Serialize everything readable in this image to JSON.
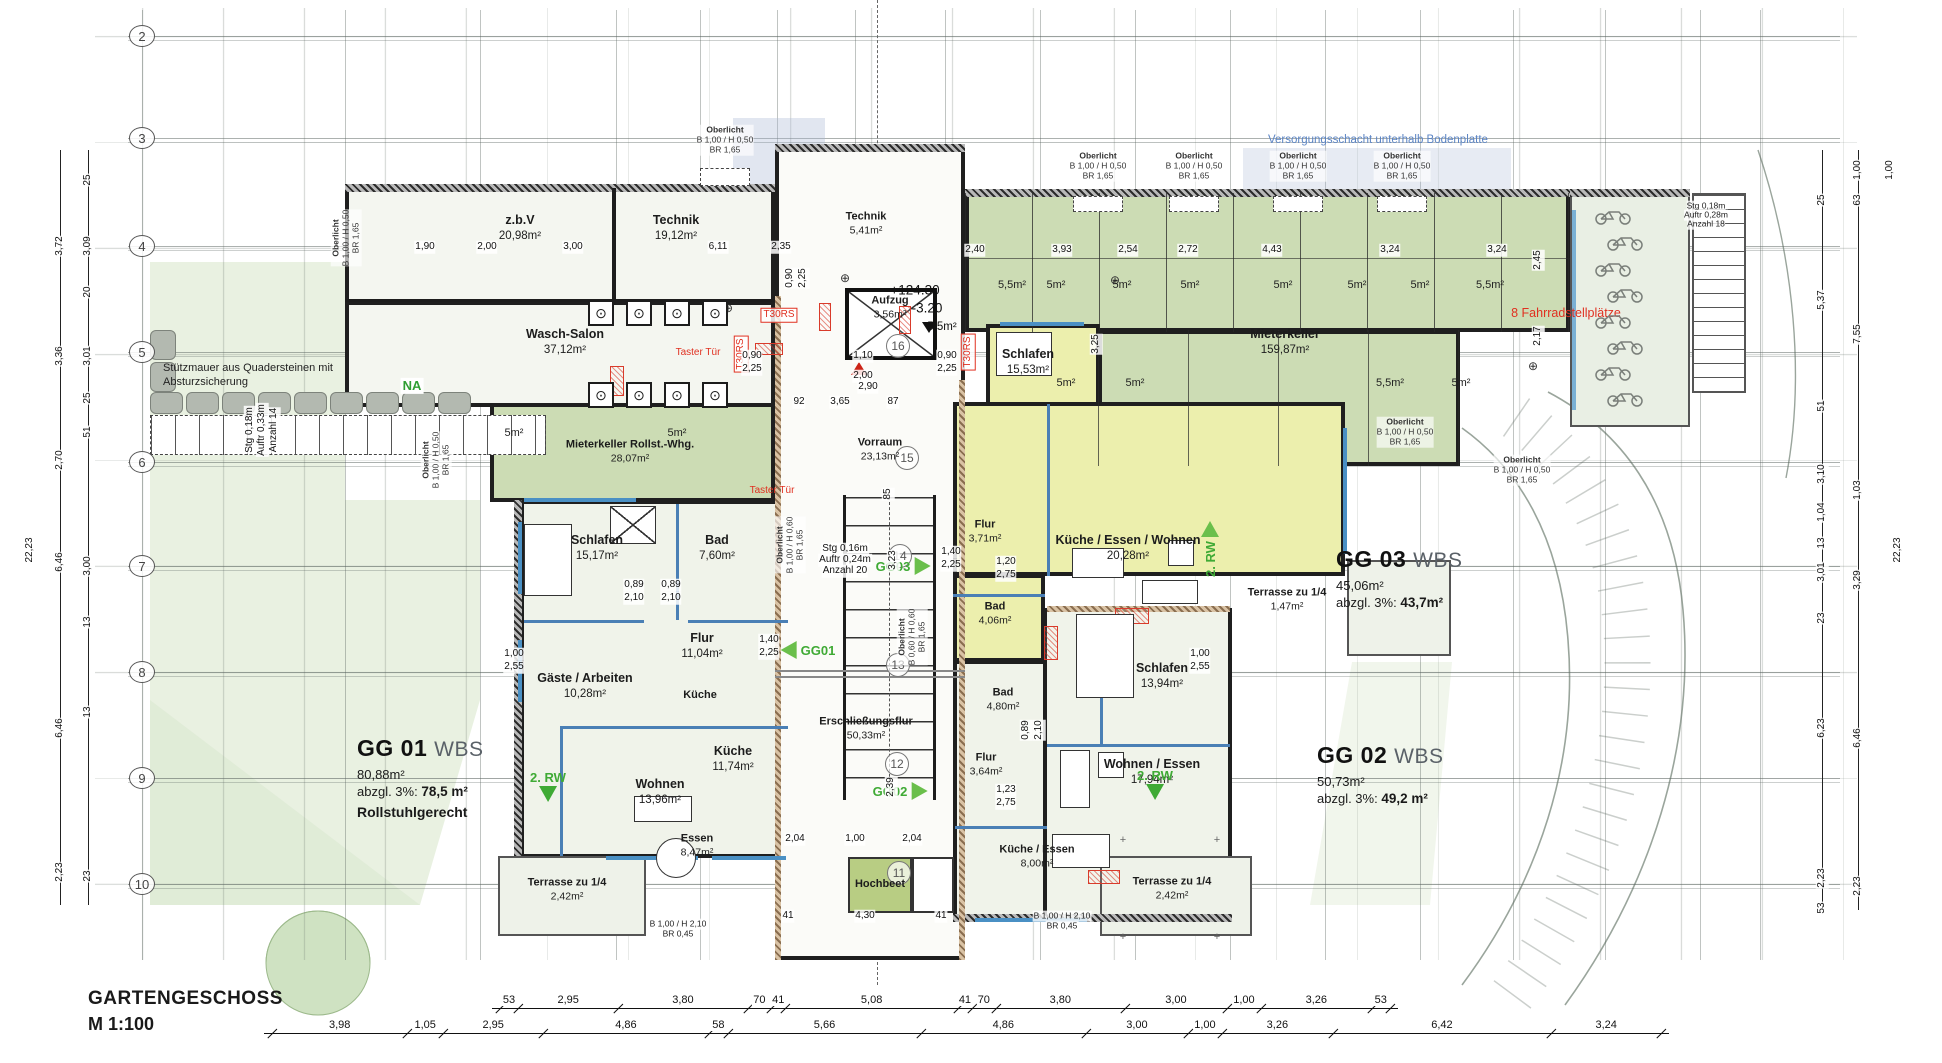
{
  "title": {
    "line1": "GARTENGESCHOSS",
    "line2": "M 1:100"
  },
  "colors": {
    "keller_green": "#ccdcb4",
    "apartment_yellow": "#ecefad",
    "floor": "#f0f3ea",
    "wall": "#1d1d1d",
    "window_blue": "#4a90c4",
    "accent_red": "#e03020",
    "arrow_green": "#3faa35",
    "annotation_blue": "#5b84c4"
  },
  "grid_bubbles": [
    {
      "n": "2",
      "y": 36
    },
    {
      "n": "3",
      "y": 138
    },
    {
      "n": "4",
      "y": 246
    },
    {
      "n": "5",
      "y": 352
    },
    {
      "n": "6",
      "y": 462
    },
    {
      "n": "7",
      "y": 566
    },
    {
      "n": "8",
      "y": 672
    },
    {
      "n": "9",
      "y": 778
    },
    {
      "n": "10",
      "y": 884
    }
  ],
  "axis_circles": [
    {
      "n": "16",
      "x": 898,
      "y": 346
    },
    {
      "n": "15",
      "x": 907,
      "y": 458
    },
    {
      "n": "14",
      "x": 900,
      "y": 556
    },
    {
      "n": "13",
      "x": 898,
      "y": 665
    },
    {
      "n": "12",
      "x": 897,
      "y": 764
    },
    {
      "n": "11",
      "x": 899,
      "y": 873
    }
  ],
  "apartments": [
    {
      "code": "GG 01",
      "std": "WBS",
      "gross": "80,88m²",
      "net_prefix": "abzgl. 3%: ",
      "net": "78,5 m²",
      "note": "Rollstuhlgerecht",
      "x": 357,
      "y": 735
    },
    {
      "code": "GG 02",
      "std": "WBS",
      "gross": "50,73m²",
      "net_prefix": "abzgl. 3%: ",
      "net": "49,2 m²",
      "note": "",
      "x": 1317,
      "y": 742
    },
    {
      "code": "GG 03",
      "std": "WBS",
      "gross": "45,06m²",
      "net_prefix": "abzgl. 3%: ",
      "net": "43,7m²",
      "note": "",
      "x": 1336,
      "y": 546
    }
  ],
  "rooms": [
    {
      "name": "z.b.V",
      "area": "20,98m²",
      "x": 520,
      "y": 228,
      "c": ""
    },
    {
      "name": "Technik",
      "area": "19,12m²",
      "x": 676,
      "y": 228,
      "c": ""
    },
    {
      "name": "Technik",
      "area": "5,41m²",
      "x": 866,
      "y": 224,
      "c": "sm"
    },
    {
      "name": "Wasch-Salon",
      "area": "37,12m²",
      "x": 565,
      "y": 342,
      "c": ""
    },
    {
      "name": "Mieterkeller Rollst.-Whg.",
      "area": "28,07m²",
      "x": 630,
      "y": 452,
      "c": "sm"
    },
    {
      "name": "Vorraum",
      "area": "23,13m²",
      "x": 880,
      "y": 450,
      "c": "sm"
    },
    {
      "name": "Mieterkeller",
      "area": "159,87m²",
      "x": 1285,
      "y": 342,
      "c": ""
    },
    {
      "name": "Aufzug",
      "area": "3,56m²",
      "x": 890,
      "y": 308,
      "c": "sm"
    },
    {
      "name": "Schlafen",
      "area": "15,17m²",
      "x": 597,
      "y": 548,
      "c": ""
    },
    {
      "name": "Bad",
      "area": "7,60m²",
      "x": 717,
      "y": 548,
      "c": ""
    },
    {
      "name": "Flur",
      "area": "11,04m²",
      "x": 702,
      "y": 646,
      "c": ""
    },
    {
      "name": "Gäste / Arbeiten",
      "area": "10,28m²",
      "x": 585,
      "y": 686,
      "c": ""
    },
    {
      "name": "Küche",
      "area": "",
      "x": 700,
      "y": 696,
      "c": "sm"
    },
    {
      "name": "Küche",
      "area": "11,74m²",
      "x": 733,
      "y": 759,
      "c": ""
    },
    {
      "name": "Wohnen",
      "area": "13,96m²",
      "x": 660,
      "y": 792,
      "c": ""
    },
    {
      "name": "Essen",
      "area": "8,47m²",
      "x": 697,
      "y": 846,
      "c": "sm"
    },
    {
      "name": "Terrasse zu 1/4",
      "area": "2,42m²",
      "x": 567,
      "y": 890,
      "c": "sm"
    },
    {
      "name": "Erschließungsflur",
      "area": "50,33m²",
      "x": 866,
      "y": 729,
      "c": "sm"
    },
    {
      "name": "Flur",
      "area": "3,71m²",
      "x": 985,
      "y": 532,
      "c": "sm"
    },
    {
      "name": "Schlafen",
      "area": "15,53m²",
      "x": 1028,
      "y": 362,
      "c": ""
    },
    {
      "name": "Küche / Essen / Wohnen",
      "area": "20,28m²",
      "x": 1128,
      "y": 548,
      "c": ""
    },
    {
      "name": "Bad",
      "area": "4,06m²",
      "x": 995,
      "y": 614,
      "c": "sm"
    },
    {
      "name": "Terrasse zu 1/4",
      "area": "1,47m²",
      "x": 1287,
      "y": 600,
      "c": "sm"
    },
    {
      "name": "Schlafen",
      "area": "13,94m²",
      "x": 1162,
      "y": 676,
      "c": ""
    },
    {
      "name": "Bad",
      "area": "4,80m²",
      "x": 1003,
      "y": 700,
      "c": "sm"
    },
    {
      "name": "Flur",
      "area": "3,64m²",
      "x": 986,
      "y": 765,
      "c": "sm"
    },
    {
      "name": "Wohnen / Essen",
      "area": "17,94m²",
      "x": 1152,
      "y": 772,
      "c": ""
    },
    {
      "name": "Küche / Essen",
      "area": "8,00m²",
      "x": 1037,
      "y": 857,
      "c": "sm"
    },
    {
      "name": "Terrasse zu 1/4",
      "area": "2,42m²",
      "x": 1172,
      "y": 889,
      "c": "sm"
    },
    {
      "name": "Hochbeet",
      "area": "",
      "x": 880,
      "y": 885,
      "c": "sm"
    }
  ],
  "annotations": [
    {
      "t": "Stützmauer aus Quadersteinen mit",
      "x": 163,
      "y": 368,
      "c": "note"
    },
    {
      "t": "Absturzsicherung",
      "x": 163,
      "y": 382,
      "c": "note"
    },
    {
      "t": "NA",
      "x": 412,
      "y": 386,
      "c": "green"
    },
    {
      "t": "Versorgungsschacht unterhalb Bodenplatte",
      "x": 1268,
      "y": 140,
      "c": "blue"
    },
    {
      "t": "8 Fahrradstellplätze",
      "x": 1566,
      "y": 314,
      "c": "red"
    },
    {
      "t": "+124.30",
      "x": 915,
      "y": 291,
      "c": "level"
    },
    {
      "t": "-3.20",
      "x": 927,
      "y": 309,
      "c": "level"
    },
    {
      "t": "5,5m²",
      "x": 942,
      "y": 327,
      "c": "levelsm"
    },
    {
      "t": "T30RS",
      "x": 779,
      "y": 315,
      "c": "redbox"
    },
    {
      "t": "T30RS",
      "x": 741,
      "y": 354,
      "c": "redbox",
      "r": 1
    },
    {
      "t": "T30RS",
      "x": 968,
      "y": 352,
      "c": "redbox",
      "r": 1
    },
    {
      "t": "Taster Tür",
      "x": 698,
      "y": 353,
      "c": "redsm"
    },
    {
      "t": "Taster Tür",
      "x": 772,
      "y": 491,
      "c": "redsm"
    },
    {
      "t": "Stg 0,16m",
      "x": 845,
      "y": 549,
      "c": "dim"
    },
    {
      "t": "Auftr 0,24m",
      "x": 845,
      "y": 560,
      "c": "dim"
    },
    {
      "t": "Anzahl 20",
      "x": 845,
      "y": 571,
      "c": "dim"
    },
    {
      "t": "Stg 0,18m",
      "x": 250,
      "y": 430,
      "c": "dim",
      "r": 1
    },
    {
      "t": "Auftr 0,33m",
      "x": 262,
      "y": 430,
      "c": "dim",
      "r": 1
    },
    {
      "t": "Anzahl 14",
      "x": 274,
      "y": 430,
      "c": "dim",
      "r": 1
    },
    {
      "t": "Stg 0,18m",
      "x": 1706,
      "y": 206,
      "c": "xs"
    },
    {
      "t": "Auftr 0,28m",
      "x": 1706,
      "y": 215,
      "c": "xs"
    },
    {
      "t": "Anzahl 18",
      "x": 1706,
      "y": 224,
      "c": "xs"
    }
  ],
  "arrows": [
    {
      "t": "GG01",
      "d": "left",
      "x": 808,
      "y": 650
    },
    {
      "t": "GG03",
      "d": "right",
      "x": 903,
      "y": 566
    },
    {
      "t": "GG02",
      "d": "right",
      "x": 900,
      "y": 791
    },
    {
      "t": "2. RW",
      "d": "down",
      "x": 548,
      "y": 786
    },
    {
      "t": "2. RW",
      "d": "right",
      "x": 1210,
      "y": 549,
      "r": 1
    },
    {
      "t": "2. RW",
      "d": "down",
      "x": 1155,
      "y": 784
    }
  ],
  "oberlicht": [
    {
      "lines": [
        "Oberlicht",
        "B 1,00 / H 0,50",
        "BR 1,65"
      ],
      "x": 725,
      "y": 140
    },
    {
      "lines": [
        "Oberlicht",
        "B 1,00 / H 0,50",
        "BR 1,65"
      ],
      "x": 1098,
      "y": 166
    },
    {
      "lines": [
        "Oberlicht",
        "B 1,00 / H 0,50",
        "BR 1,65"
      ],
      "x": 1194,
      "y": 166
    },
    {
      "lines": [
        "Oberlicht",
        "B 1,00 / H 0,50",
        "BR 1,65"
      ],
      "x": 1298,
      "y": 166
    },
    {
      "lines": [
        "Oberlicht",
        "B 1,00 / H 0,50",
        "BR 1,65"
      ],
      "x": 1402,
      "y": 166
    },
    {
      "lines": [
        "Oberlicht",
        "B 1,00 / H 0,50",
        "BR 1,65"
      ],
      "x": 1405,
      "y": 432
    },
    {
      "lines": [
        "Oberlicht",
        "B 1,00 / H 0,50",
        "BR 1,65"
      ],
      "x": 1522,
      "y": 470
    },
    {
      "lines": [
        "Oberlicht",
        "B 1,00 / H 0,50",
        "BR 1,65"
      ],
      "x": 346,
      "y": 238,
      "r": 1
    },
    {
      "lines": [
        "Oberlicht",
        "B 1,00 / H 0,50",
        "BR 1,65"
      ],
      "x": 436,
      "y": 460,
      "r": 1
    },
    {
      "lines": [
        "Oberlicht",
        "B 1,00 / H 0,60",
        "BR 1,65"
      ],
      "x": 790,
      "y": 545,
      "r": 1
    },
    {
      "lines": [
        "Oberlicht",
        "B 0,60 / H 0,60",
        "BR 1,65"
      ],
      "x": 912,
      "y": 637,
      "r": 1
    }
  ],
  "dims": [
    {
      "t": "1,90",
      "x": 425,
      "y": 247
    },
    {
      "t": "2,00",
      "x": 487,
      "y": 247
    },
    {
      "t": "3,00",
      "x": 573,
      "y": 247
    },
    {
      "t": "6,11",
      "x": 718,
      "y": 247
    },
    {
      "t": "2,35",
      "x": 781,
      "y": 247
    },
    {
      "t": "0,90",
      "x": 790,
      "y": 278,
      "r": 1
    },
    {
      "t": "2,25",
      "x": 803,
      "y": 278,
      "r": 1
    },
    {
      "t": "0,90",
      "x": 752,
      "y": 356
    },
    {
      "t": "2,25",
      "x": 752,
      "y": 369
    },
    {
      "t": "0,90",
      "x": 947,
      "y": 356
    },
    {
      "t": "2,25",
      "x": 947,
      "y": 369
    },
    {
      "t": "1,10",
      "x": 863,
      "y": 356
    },
    {
      "t": "2,00",
      "x": 863,
      "y": 376
    },
    {
      "t": "92",
      "x": 799,
      "y": 402
    },
    {
      "t": "3,65",
      "x": 840,
      "y": 402
    },
    {
      "t": "87",
      "x": 893,
      "y": 402
    },
    {
      "t": "2,90",
      "x": 868,
      "y": 387
    },
    {
      "t": "3,25",
      "x": 1096,
      "y": 344,
      "r": 1
    },
    {
      "t": "2,40",
      "x": 975,
      "y": 250
    },
    {
      "t": "3,93",
      "x": 1062,
      "y": 250
    },
    {
      "t": "2,54",
      "x": 1128,
      "y": 250
    },
    {
      "t": "2,72",
      "x": 1188,
      "y": 250
    },
    {
      "t": "4,43",
      "x": 1272,
      "y": 250
    },
    {
      "t": "3,24",
      "x": 1390,
      "y": 250
    },
    {
      "t": "3,24",
      "x": 1497,
      "y": 250
    },
    {
      "t": "2,45",
      "x": 1538,
      "y": 260,
      "r": 1
    },
    {
      "t": "2,17",
      "x": 1538,
      "y": 336,
      "r": 1
    },
    {
      "t": "5,5m²",
      "x": 1012,
      "y": 286,
      "c": "cell"
    },
    {
      "t": "5m²",
      "x": 1056,
      "y": 286,
      "c": "cell"
    },
    {
      "t": "5m²",
      "x": 1122,
      "y": 286,
      "c": "cell"
    },
    {
      "t": "5m²",
      "x": 1190,
      "y": 286,
      "c": "cell"
    },
    {
      "t": "5m²",
      "x": 1283,
      "y": 286,
      "c": "cell"
    },
    {
      "t": "5m²",
      "x": 1357,
      "y": 286,
      "c": "cell"
    },
    {
      "t": "5m²",
      "x": 1420,
      "y": 286,
      "c": "cell"
    },
    {
      "t": "5,5m²",
      "x": 1490,
      "y": 286,
      "c": "cell"
    },
    {
      "t": "5m²",
      "x": 1066,
      "y": 384,
      "c": "cell"
    },
    {
      "t": "5m²",
      "x": 1135,
      "y": 384,
      "c": "cell"
    },
    {
      "t": "5,5m²",
      "x": 1390,
      "y": 384,
      "c": "cell"
    },
    {
      "t": "5m²",
      "x": 1461,
      "y": 384,
      "c": "cell"
    },
    {
      "t": "5m²",
      "x": 514,
      "y": 434,
      "c": "cell"
    },
    {
      "t": "5m²",
      "x": 677,
      "y": 434,
      "c": "cell"
    },
    {
      "t": "0,89",
      "x": 634,
      "y": 585
    },
    {
      "t": "2,10",
      "x": 634,
      "y": 598
    },
    {
      "t": "0,89",
      "x": 671,
      "y": 585
    },
    {
      "t": "2,10",
      "x": 671,
      "y": 598
    },
    {
      "t": "1,40",
      "x": 769,
      "y": 640
    },
    {
      "t": "2,25",
      "x": 769,
      "y": 653
    },
    {
      "t": "1,00",
      "x": 514,
      "y": 654
    },
    {
      "t": "2,55",
      "x": 514,
      "y": 667
    },
    {
      "t": "1,40",
      "x": 951,
      "y": 552
    },
    {
      "t": "2,25",
      "x": 951,
      "y": 565
    },
    {
      "t": "1,20",
      "x": 1006,
      "y": 562
    },
    {
      "t": "2,75",
      "x": 1006,
      "y": 575
    },
    {
      "t": "1,00",
      "x": 1200,
      "y": 654
    },
    {
      "t": "2,55",
      "x": 1200,
      "y": 667
    },
    {
      "t": "0,89",
      "x": 1026,
      "y": 730,
      "r": 1
    },
    {
      "t": "2,10",
      "x": 1039,
      "y": 730,
      "r": 1
    },
    {
      "t": "1,23",
      "x": 1006,
      "y": 790
    },
    {
      "t": "2,75",
      "x": 1006,
      "y": 803
    },
    {
      "t": "85",
      "x": 888,
      "y": 494,
      "r": 1
    },
    {
      "t": "3,23",
      "x": 893,
      "y": 560,
      "r": 1
    },
    {
      "t": "2,39",
      "x": 891,
      "y": 787,
      "r": 1
    },
    {
      "t": "2,04",
      "x": 795,
      "y": 839
    },
    {
      "t": "1,00",
      "x": 855,
      "y": 839
    },
    {
      "t": "2,04",
      "x": 912,
      "y": 839
    },
    {
      "t": "41",
      "x": 788,
      "y": 916
    },
    {
      "t": "4,30",
      "x": 865,
      "y": 916
    },
    {
      "t": "41",
      "x": 941,
      "y": 916
    },
    {
      "t": "B 1,00 / H 2,10",
      "x": 678,
      "y": 924,
      "c": "xs"
    },
    {
      "t": "BR 0,45",
      "x": 678,
      "y": 934,
      "c": "xs"
    },
    {
      "t": "B 1,00 / H 2,10",
      "x": 1062,
      "y": 916,
      "c": "xs"
    },
    {
      "t": "BR 0,45",
      "x": 1062,
      "y": 926,
      "c": "xs"
    },
    {
      "t": "25",
      "x": 88,
      "y": 180,
      "r": 1
    },
    {
      "t": "3,72",
      "x": 60,
      "y": 246,
      "r": 1
    },
    {
      "t": "3,09",
      "x": 88,
      "y": 246,
      "r": 1
    },
    {
      "t": "20",
      "x": 88,
      "y": 292,
      "r": 1
    },
    {
      "t": "3,36",
      "x": 60,
      "y": 356,
      "r": 1
    },
    {
      "t": "3,01",
      "x": 88,
      "y": 356,
      "r": 1
    },
    {
      "t": "25",
      "x": 88,
      "y": 398,
      "r": 1
    },
    {
      "t": "2,70",
      "x": 60,
      "y": 460,
      "r": 1
    },
    {
      "t": "51",
      "x": 88,
      "y": 432,
      "r": 1
    },
    {
      "t": "6,46",
      "x": 60,
      "y": 562,
      "r": 1
    },
    {
      "t": "3,00",
      "x": 88,
      "y": 566,
      "r": 1
    },
    {
      "t": "22,23",
      "x": 30,
      "y": 550,
      "r": 1
    },
    {
      "t": "13",
      "x": 88,
      "y": 622,
      "r": 1
    },
    {
      "t": "6,46",
      "x": 60,
      "y": 728,
      "r": 1
    },
    {
      "t": "13",
      "x": 88,
      "y": 712,
      "r": 1
    },
    {
      "t": "2,23",
      "x": 60,
      "y": 872,
      "r": 1
    },
    {
      "t": "23",
      "x": 88,
      "y": 876,
      "r": 1
    },
    {
      "t": "1,00",
      "x": 1858,
      "y": 170,
      "r": 1
    },
    {
      "t": "1,00",
      "x": 1890,
      "y": 170,
      "r": 1
    },
    {
      "t": "25",
      "x": 1822,
      "y": 200,
      "r": 1
    },
    {
      "t": "63",
      "x": 1858,
      "y": 200,
      "r": 1
    },
    {
      "t": "5,37",
      "x": 1822,
      "y": 300,
      "r": 1
    },
    {
      "t": "7,55",
      "x": 1858,
      "y": 334,
      "r": 1
    },
    {
      "t": "51",
      "x": 1822,
      "y": 406,
      "r": 1
    },
    {
      "t": "3,10",
      "x": 1822,
      "y": 474,
      "r": 1
    },
    {
      "t": "1,03",
      "x": 1858,
      "y": 490,
      "r": 1
    },
    {
      "t": "1,04",
      "x": 1822,
      "y": 512,
      "r": 1
    },
    {
      "t": "13",
      "x": 1822,
      "y": 543,
      "r": 1
    },
    {
      "t": "22,23",
      "x": 1898,
      "y": 550,
      "r": 1
    },
    {
      "t": "3,01",
      "x": 1822,
      "y": 572,
      "r": 1
    },
    {
      "t": "3,29",
      "x": 1858,
      "y": 580,
      "r": 1
    },
    {
      "t": "23",
      "x": 1822,
      "y": 618,
      "r": 1
    },
    {
      "t": "6,23",
      "x": 1822,
      "y": 728,
      "r": 1
    },
    {
      "t": "6,46",
      "x": 1858,
      "y": 738,
      "r": 1
    },
    {
      "t": "2,23",
      "x": 1822,
      "y": 878,
      "r": 1
    },
    {
      "t": "53",
      "x": 1822,
      "y": 908,
      "r": 1
    },
    {
      "t": "2,23",
      "x": 1858,
      "y": 886,
      "r": 1
    }
  ],
  "chains": [
    {
      "y": 1008,
      "x0": 500,
      "scale": 34,
      "values": [
        "53",
        "2,95",
        "3,80",
        "70",
        "41",
        "5,08",
        "41",
        "70",
        "3,80",
        "3,00",
        "1,00",
        "3,26",
        "53"
      ]
    },
    {
      "y": 1033,
      "x0": 272,
      "scale": 34,
      "values": [
        "3,98",
        "1,05",
        "2,95",
        "4,86",
        "58",
        "5,66",
        "4,86",
        "3,00",
        "1,00",
        "3,26",
        "6,42",
        "3,24"
      ]
    }
  ],
  "washer_rows": [
    {
      "x": 588,
      "y": 300,
      "count": 4
    },
    {
      "x": 588,
      "y": 382,
      "count": 4
    }
  ],
  "bike_count": 8
}
